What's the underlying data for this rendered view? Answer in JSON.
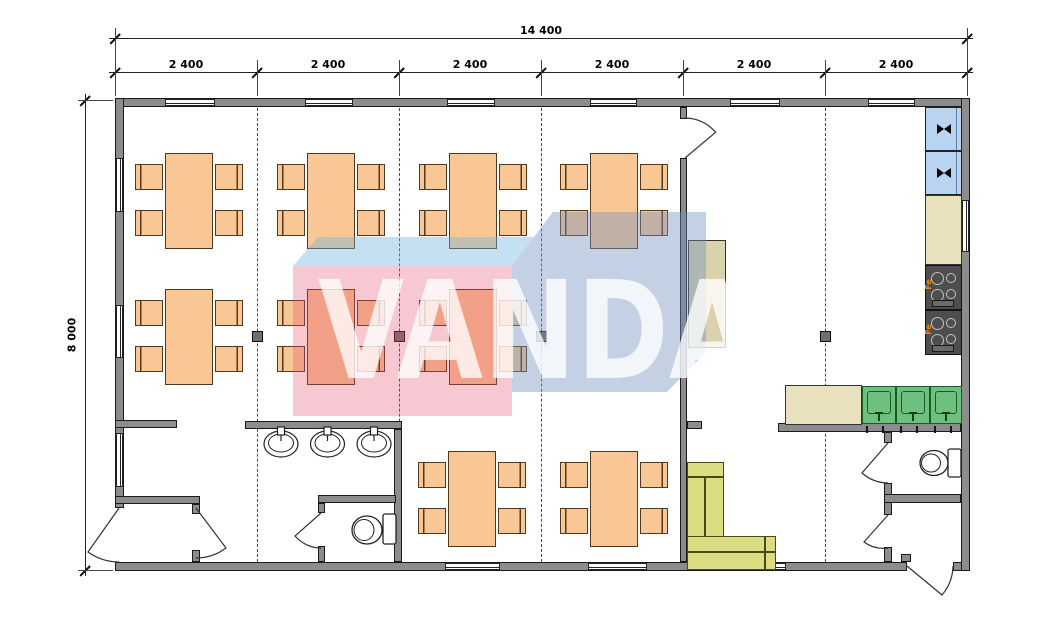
{
  "watermark": {
    "text": "VANDA",
    "colors": {
      "pink": "rgba(230,70,105,0.3)",
      "blue": "rgba(115,145,190,0.42)",
      "top_face": "rgba(110,180,220,0.4)",
      "letters": "#ffffff"
    }
  },
  "dimensions": {
    "total": "14 400",
    "height": "8 000",
    "segments": [
      "2 400",
      "2 400",
      "2 400",
      "2 400",
      "2 400",
      "2 400"
    ],
    "ticks": [
      115,
      257,
      399,
      541,
      683,
      825,
      967
    ],
    "line1_y": 38,
    "line2_y": 72,
    "left_line_x": 85,
    "top_y": 100,
    "bottom_y": 570
  },
  "labels": {
    "stove": "Fe"
  },
  "plan": {
    "wall_color": "#8C8C8C",
    "furniture_color": "#F9C795",
    "walls": [
      {
        "x": 115,
        "y": 98,
        "w": 855,
        "h": 9
      },
      {
        "x": 115,
        "y": 562,
        "w": 792,
        "h": 9
      },
      {
        "x": 953,
        "y": 562,
        "w": 17,
        "h": 9
      },
      {
        "x": 115,
        "y": 98,
        "w": 9,
        "h": 410
      },
      {
        "x": 961,
        "y": 98,
        "w": 9,
        "h": 473
      },
      {
        "x": 115,
        "y": 420,
        "w": 62,
        "h": 8
      },
      {
        "x": 115,
        "y": 496,
        "w": 85,
        "h": 8
      },
      {
        "x": 192,
        "y": 504,
        "w": 8,
        "h": 10
      },
      {
        "x": 192,
        "y": 550,
        "w": 8,
        "h": 12
      },
      {
        "x": 245,
        "y": 421,
        "w": 157,
        "h": 8
      },
      {
        "x": 394,
        "y": 429,
        "w": 8,
        "h": 133
      },
      {
        "x": 318,
        "y": 495,
        "w": 78,
        "h": 8
      },
      {
        "x": 318,
        "y": 503,
        "w": 7,
        "h": 10
      },
      {
        "x": 318,
        "y": 546,
        "w": 7,
        "h": 16
      },
      {
        "x": 680,
        "y": 107,
        "w": 7,
        "h": 12
      },
      {
        "x": 680,
        "y": 158,
        "w": 7,
        "h": 404
      },
      {
        "x": 687,
        "y": 421,
        "w": 15,
        "h": 8
      },
      {
        "x": 778,
        "y": 423,
        "w": 183,
        "h": 9
      },
      {
        "x": 884,
        "y": 432,
        "w": 8,
        "h": 11
      },
      {
        "x": 884,
        "y": 483,
        "w": 8,
        "h": 32
      },
      {
        "x": 884,
        "y": 547,
        "w": 8,
        "h": 15
      },
      {
        "x": 884,
        "y": 494,
        "w": 77,
        "h": 9
      },
      {
        "x": 901,
        "y": 554,
        "w": 10,
        "h": 8
      }
    ],
    "windows": [
      {
        "x": 165,
        "y": 99,
        "w": 50,
        "h": 7,
        "o": "h"
      },
      {
        "x": 305,
        "y": 99,
        "w": 48,
        "h": 7,
        "o": "h"
      },
      {
        "x": 447,
        "y": 99,
        "w": 48,
        "h": 7,
        "o": "h"
      },
      {
        "x": 590,
        "y": 99,
        "w": 47,
        "h": 7,
        "o": "h"
      },
      {
        "x": 730,
        "y": 99,
        "w": 50,
        "h": 7,
        "o": "h"
      },
      {
        "x": 868,
        "y": 99,
        "w": 47,
        "h": 7,
        "o": "h"
      },
      {
        "x": 445,
        "y": 563,
        "w": 55,
        "h": 7,
        "o": "h"
      },
      {
        "x": 588,
        "y": 563,
        "w": 59,
        "h": 7,
        "o": "h"
      },
      {
        "x": 728,
        "y": 563,
        "w": 58,
        "h": 7,
        "o": "h"
      },
      {
        "x": 116,
        "y": 158,
        "w": 7,
        "h": 54,
        "o": "v"
      },
      {
        "x": 116,
        "y": 305,
        "w": 7,
        "h": 53,
        "o": "v"
      },
      {
        "x": 116,
        "y": 433,
        "w": 7,
        "h": 54,
        "o": "v"
      },
      {
        "x": 962,
        "y": 200,
        "w": 7,
        "h": 52,
        "o": "v"
      }
    ],
    "grid_lines": [
      257,
      399,
      541,
      825
    ],
    "grid_top": 108,
    "grid_bottom": 562,
    "columns": [
      [
        252,
        331
      ],
      [
        394,
        331
      ],
      [
        536,
        331
      ],
      [
        820,
        331
      ]
    ],
    "dining_tables": [
      [
        165,
        153
      ],
      [
        307,
        153
      ],
      [
        449,
        153
      ],
      [
        590,
        153
      ],
      [
        165,
        289
      ],
      [
        307,
        289
      ],
      [
        449,
        289
      ],
      [
        448,
        451
      ],
      [
        590,
        451
      ]
    ],
    "fixtures": [
      {
        "type": "fridge",
        "name": "refrigerator",
        "x": 925,
        "y": 107,
        "w": 37,
        "h": 44
      },
      {
        "type": "fridge",
        "name": "refrigerator",
        "x": 925,
        "y": 151,
        "w": 37,
        "h": 44
      },
      {
        "type": "rect",
        "name": "kitchen-counter",
        "x": 925,
        "y": 195,
        "w": 37,
        "h": 70,
        "fill": "#E9E1BE"
      },
      {
        "type": "stove",
        "name": "electric-stove",
        "x": 925,
        "y": 265,
        "w": 37,
        "h": 45
      },
      {
        "type": "stove",
        "name": "electric-stove",
        "x": 925,
        "y": 310,
        "w": 37,
        "h": 45
      },
      {
        "type": "rect",
        "name": "kitchen-counter",
        "x": 785,
        "y": 385,
        "w": 77,
        "h": 40,
        "fill": "#E9E1BE"
      },
      {
        "type": "sink",
        "name": "kitchen-sink",
        "x": 862,
        "y": 386,
        "w": 34,
        "h": 38
      },
      {
        "type": "sink",
        "name": "kitchen-sink",
        "x": 896,
        "y": 386,
        "w": 34,
        "h": 38
      },
      {
        "type": "sink",
        "name": "kitchen-sink",
        "x": 930,
        "y": 386,
        "w": 32,
        "h": 38
      },
      {
        "type": "rect",
        "name": "cabinet",
        "x": 688,
        "y": 240,
        "w": 38,
        "h": 108,
        "fill": "#D9D2AC"
      },
      {
        "type": "rect",
        "name": "sofa-section",
        "x": 687,
        "y": 462,
        "w": 37,
        "h": 75,
        "fill": "#DCDC82",
        "stroke": "#4a4a16"
      },
      {
        "type": "rect",
        "name": "sofa-section",
        "x": 687,
        "y": 536,
        "w": 89,
        "h": 34,
        "fill": "#DCDC82",
        "stroke": "#4a4a16"
      },
      {
        "type": "line",
        "name": "sofa-seam",
        "x": 704,
        "y": 477,
        "w": 1.5,
        "h": 60
      },
      {
        "type": "line",
        "name": "sofa-seam",
        "x": 687,
        "y": 476,
        "w": 37,
        "h": 1.5
      },
      {
        "type": "line",
        "name": "sofa-seam",
        "x": 687,
        "y": 551,
        "w": 88,
        "h": 1.5
      },
      {
        "type": "line",
        "name": "sofa-seam",
        "x": 764,
        "y": 536,
        "w": 1.5,
        "h": 34
      }
    ],
    "doors": [
      {
        "name": "door-swing",
        "d": "M685,118 A40,40 0 0 1 715.6,132.3 L685,158"
      },
      {
        "name": "door-swing",
        "d": "M119,562 A54,54 0 0 1 88,552 L119,508"
      },
      {
        "name": "door-swing",
        "d": "M196,558 A50,50 0 0 0 226,548 L196,508"
      },
      {
        "name": "door-swing",
        "d": "M321,548 A35,35 0 0 1 295,536 L321,513"
      },
      {
        "name": "door-swing",
        "d": "M888,483 A40,40 0 0 1 862,473 L888,443"
      },
      {
        "name": "door-swing",
        "d": "M888,548 A33,33 0 0 1 864,542 L888,515"
      },
      {
        "name": "door-swing",
        "d": "M953,566 A46,46 0 0 1 942,595 L907,566"
      }
    ],
    "toilets": [
      {
        "tank": [
          383,
          514,
          13,
          30
        ],
        "bowl": [
          367,
          530,
          15,
          14
        ],
        "inner": [
          364,
          530,
          10,
          10.5
        ]
      },
      {
        "tank": [
          948,
          449,
          13,
          28
        ],
        "bowl": [
          934,
          463,
          14,
          12.5
        ],
        "inner": [
          931,
          463,
          9.5,
          9
        ]
      }
    ],
    "basins": [
      {
        "cx": 281
      },
      {
        "cx": 327.5
      },
      {
        "cx": 374
      }
    ],
    "sink_ticks": [
      867,
      883,
      901,
      917,
      935,
      951
    ]
  }
}
